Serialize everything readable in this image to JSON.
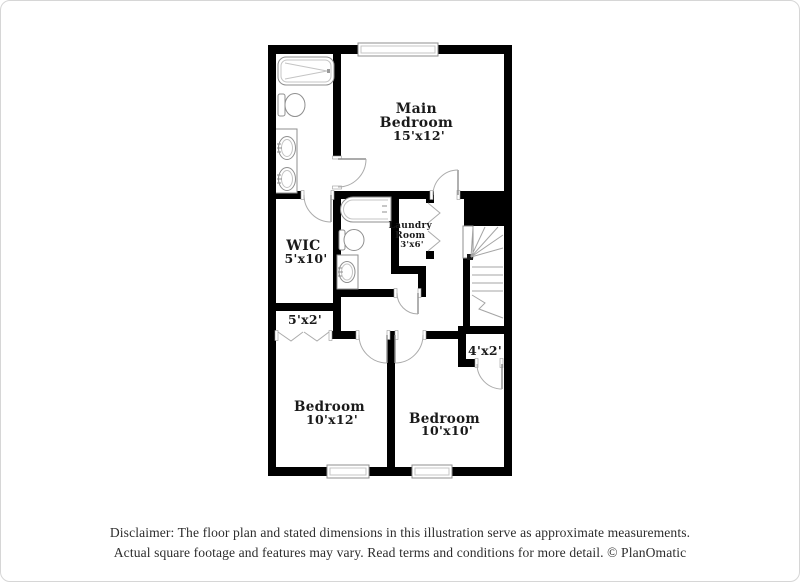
{
  "page": {
    "background": "#ffffff",
    "border_color": "#d6d6d6"
  },
  "floor_plan": {
    "wall_color": "#000000",
    "fixture_outline_color": "#8f8f8f",
    "label_color": "#1a1a1a",
    "rooms": {
      "main_bedroom": {
        "name_line1": "Main",
        "name_line2": "Bedroom",
        "dimensions": "15'x12'"
      },
      "wic": {
        "name": "WIC",
        "dimensions": "5'x10'"
      },
      "laundry_room": {
        "name_line1": "Laundry",
        "name_line2": "Room",
        "dimensions": "3'x6'"
      },
      "bedroom_left": {
        "name": "Bedroom",
        "dimensions": "10'x12'"
      },
      "bedroom_right": {
        "name": "Bedroom",
        "dimensions": "10'x10'"
      },
      "closet_hall": {
        "dimensions": "5'x2'"
      },
      "closet_bedroom_right": {
        "dimensions": "4'x2'"
      }
    },
    "fixtures": [
      "bathtub",
      "toilet",
      "double-sink-vanity",
      "bathtub",
      "toilet",
      "sink",
      "staircase",
      "windows",
      "bifold-doors"
    ]
  },
  "disclaimer": {
    "line1": "Disclaimer: The floor plan and stated dimensions in this illustration serve as approximate measurements.",
    "line2": "Actual square footage and features may vary. Read terms and conditions for more detail. © PlanOmatic"
  }
}
